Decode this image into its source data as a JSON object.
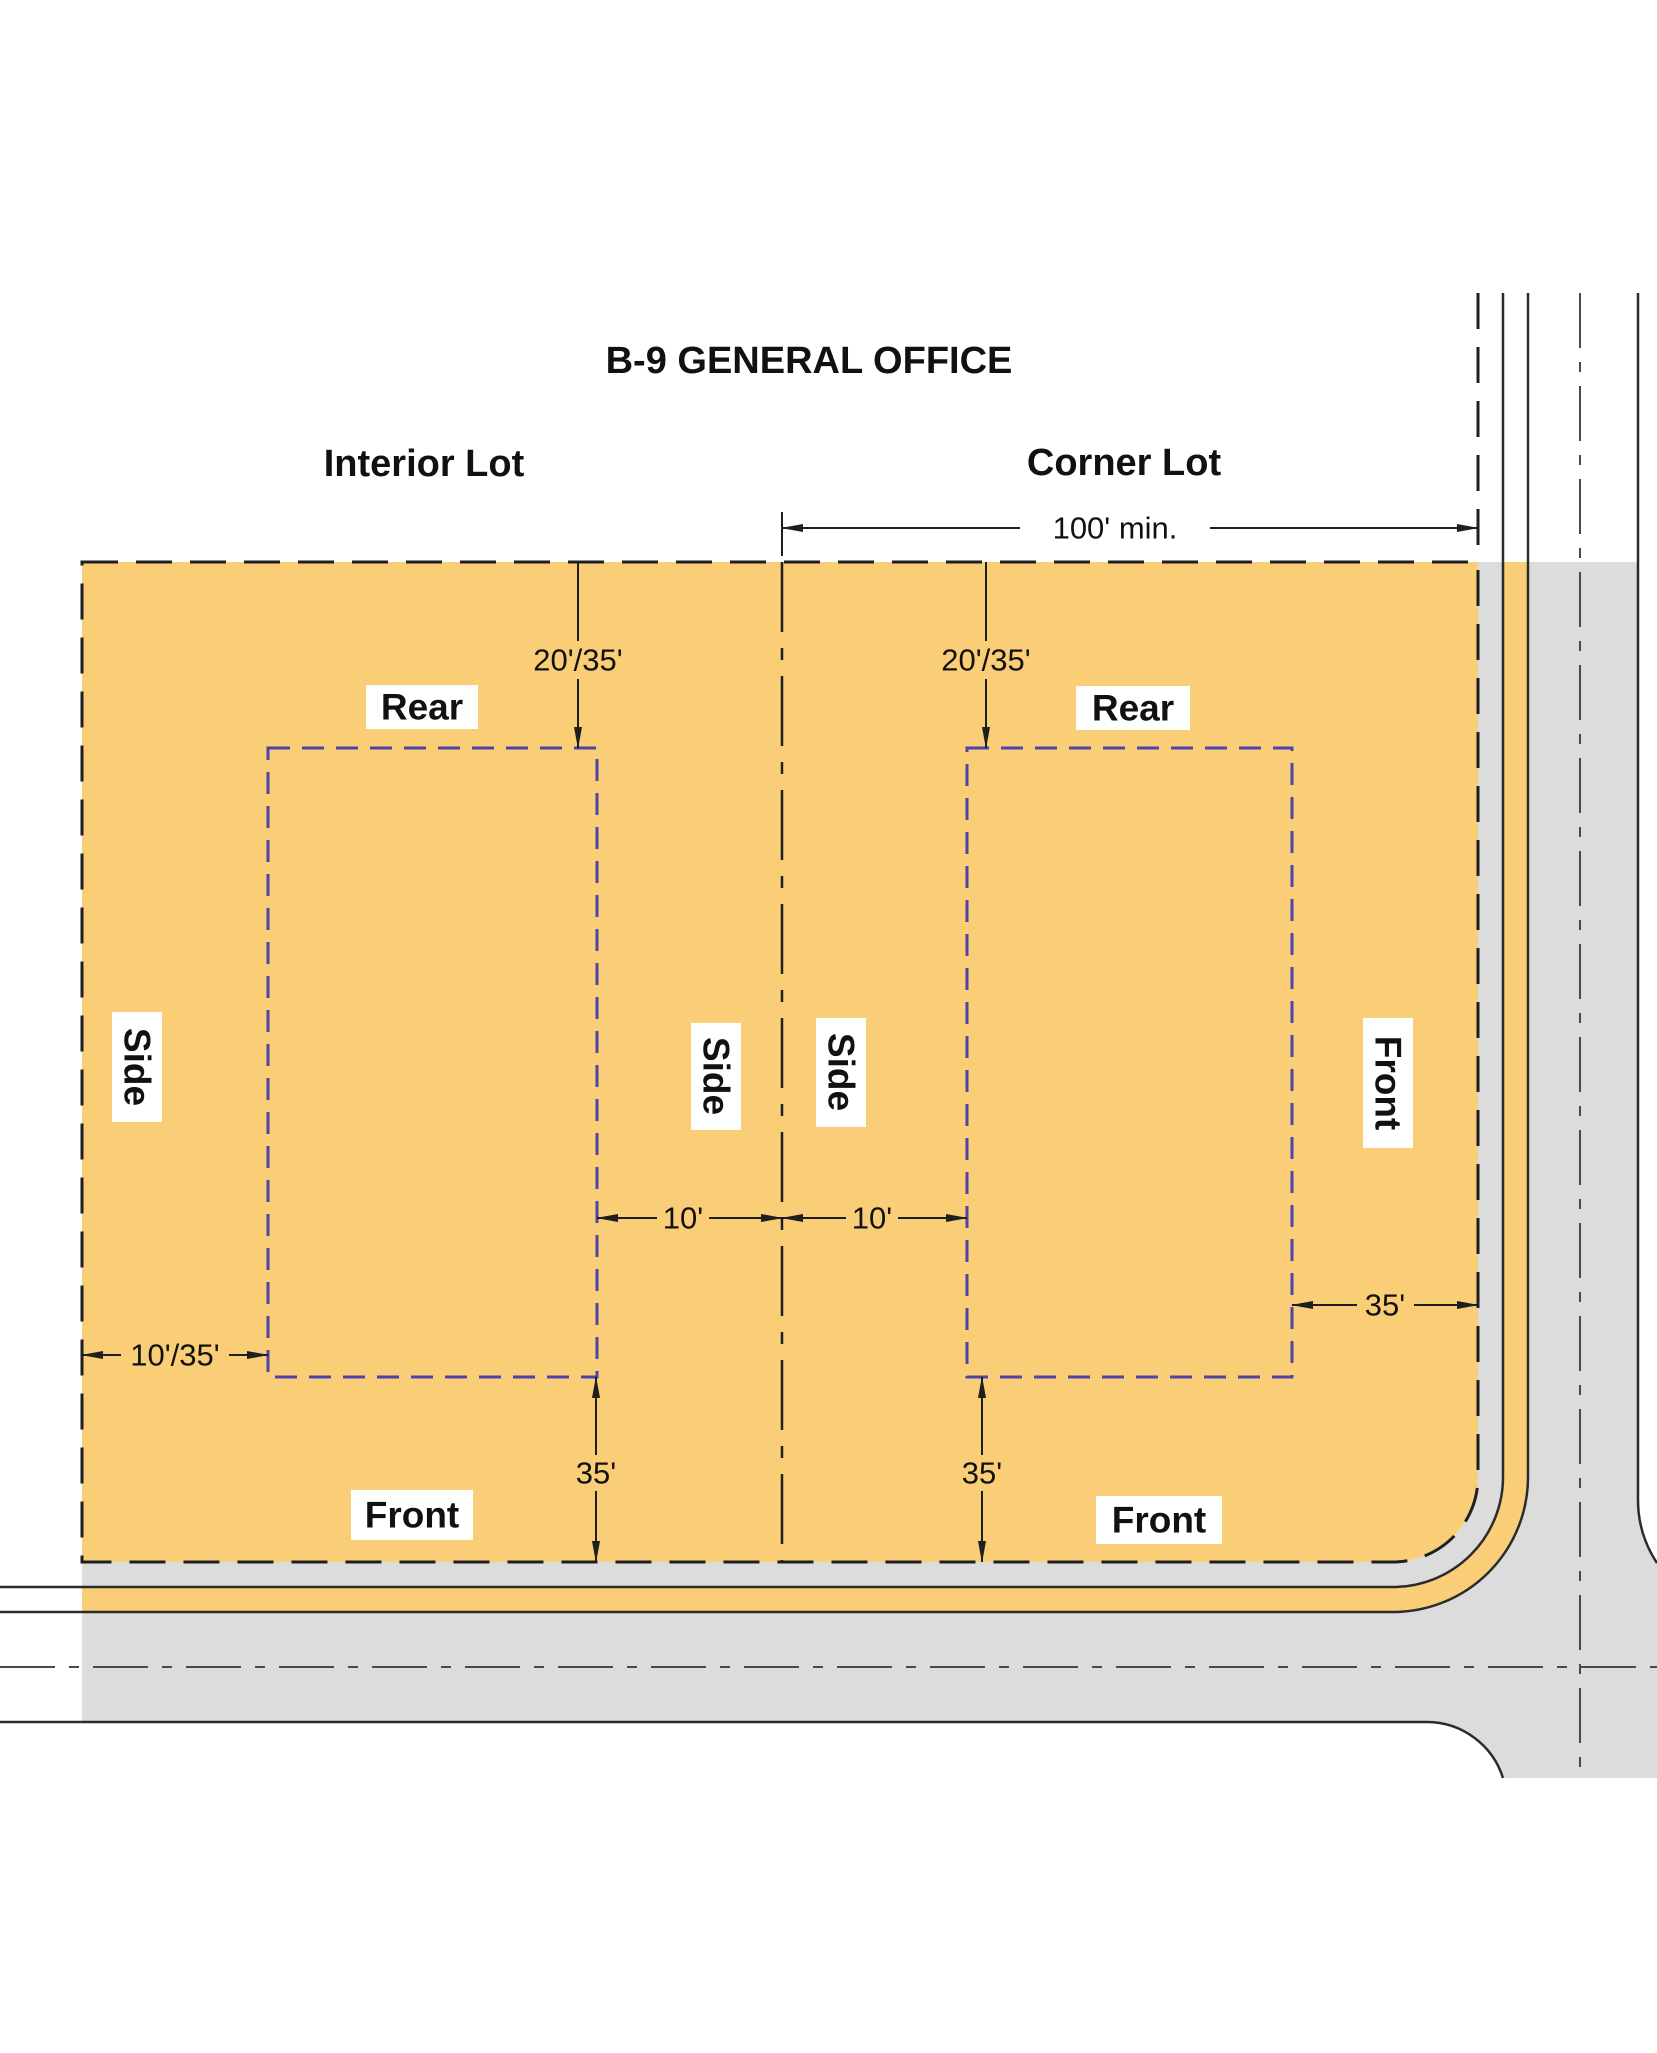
{
  "title": "B-9 GENERAL OFFICE",
  "colors": {
    "lot_fill": "#F9CE77",
    "road_fill": "#DCDCDC",
    "parkway_fill": "#F9CE77",
    "envelope_stroke": "#4F42A8",
    "line_color": "#1F1F1F",
    "label_box_fill": "#FFFFFF"
  },
  "interior_lot": {
    "label": "Interior Lot",
    "rear_label": "Rear",
    "side_label": "Side",
    "front_label": "Front",
    "rear_setback": "20'/35'",
    "interior_side_setback": "10'",
    "street_side_setback": "10'/35'",
    "front_setback": "35'"
  },
  "corner_lot": {
    "label": "Corner Lot",
    "min_lot_width": "100' min.",
    "rear_label": "Rear",
    "side_label": "Side",
    "front_side_label": "Front",
    "front_label": "Front",
    "rear_setback": "20'/35'",
    "interior_side_setback": "10'",
    "street_front_setback": "35'",
    "front_setback": "35'"
  }
}
